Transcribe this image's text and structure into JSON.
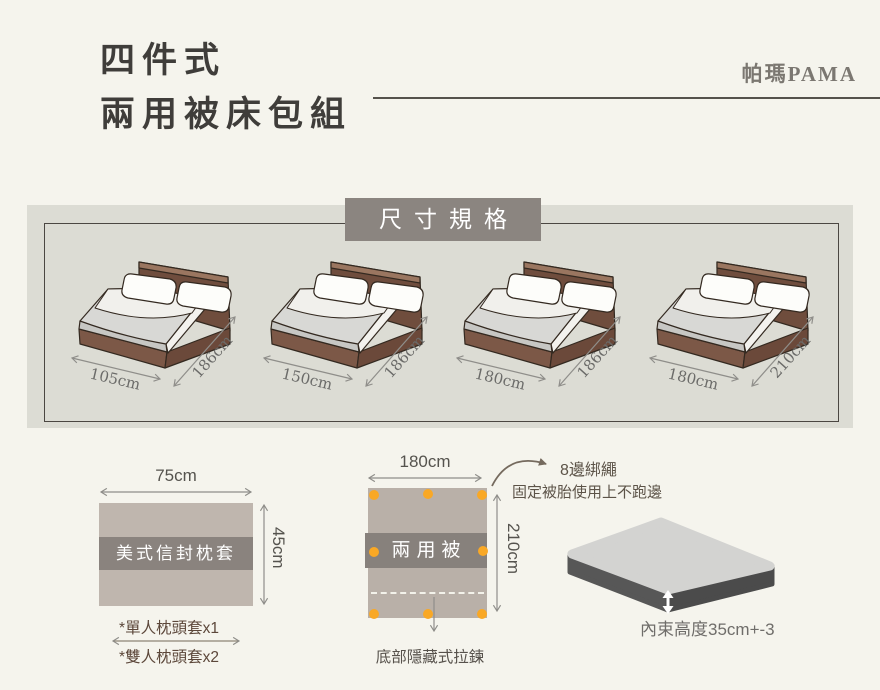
{
  "header": {
    "title_line1": "四件式",
    "title_line2": "兩用被床包組",
    "brand": "帕瑪PAMA"
  },
  "spec_panel": {
    "badge": "尺寸規格",
    "beds": [
      {
        "width": "105cm",
        "length": "186cm"
      },
      {
        "width": "150cm",
        "length": "186cm"
      },
      {
        "width": "180cm",
        "length": "186cm"
      },
      {
        "width": "180cm",
        "length": "210cm"
      }
    ]
  },
  "pillowcase": {
    "label": "美式信封枕套",
    "width": "75cm",
    "height": "45cm",
    "notes": [
      "*單人枕頭套x1",
      "*雙人枕頭套x2"
    ]
  },
  "quilt": {
    "label": "兩用被",
    "width": "180cm",
    "height": "210cm",
    "tie_title": "8邊綁繩",
    "tie_desc": "固定被胎使用上不跑邊",
    "zipper_note": "底部隱藏式拉鍊",
    "tie_dot_count": "8"
  },
  "mattress": {
    "depth_note": "內束高度35cm+-3"
  },
  "colors": {
    "background": "#f5f4ed",
    "panel": "#dcdcd4",
    "band": "#8b8580",
    "accent_dot": "#f9a825",
    "bed_brown": "#6f4d3d",
    "title_text": "#3f3d3a"
  }
}
